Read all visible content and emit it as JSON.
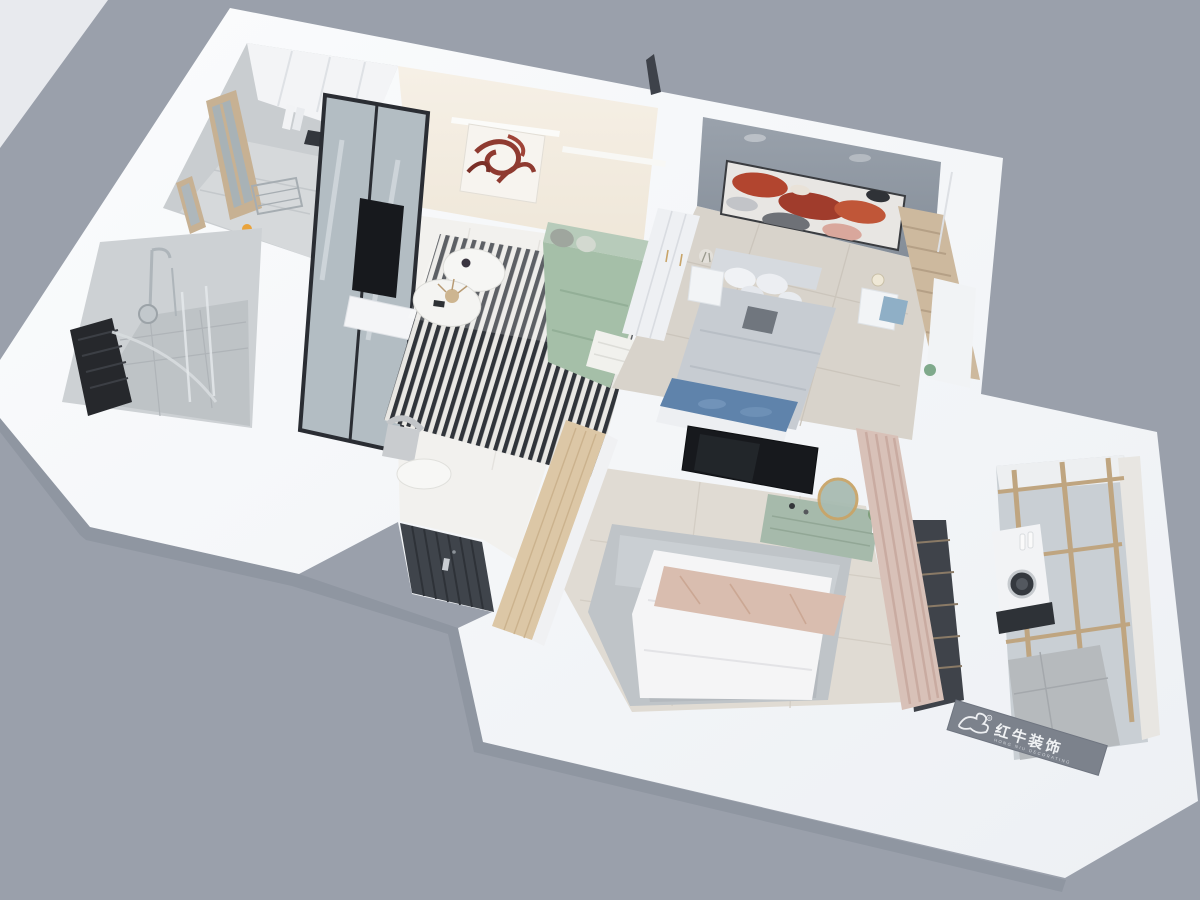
{
  "scene": {
    "type": "3d-apartment-floorplan-render",
    "watermark": {
      "logo_icon": "bull-icon",
      "registered_mark": "®",
      "brand": "红牛装饰",
      "subtitle": "HONG NIU DECORATING"
    },
    "palette": {
      "background": "#9AA0AB",
      "backdrop_slab": "#E8EAEE",
      "walls_white": "#F8F9FB",
      "living_wall_cream": "#F3EDE2",
      "bedroom_accent_wall": "#8F97A1",
      "wood_frame": "#C7B193",
      "wardrobe_wood": "#DCC7A6",
      "sofa_green": "#A5BFA8",
      "blanket_blush": "#D9BDAF",
      "runner_blue": "#5F83AB",
      "rug_stripe_dark": "#30343A",
      "rug_gray": "#BFC4C8",
      "entry_door": "#3F444B",
      "tv_black": "#17191D",
      "dresser_green": "#A6BAAB",
      "mirror_gold": "#C8A468",
      "curtain_pink": "#D8C1B8",
      "tile_gray": "#C9CDD0",
      "banner_gray": "#7C828C",
      "art_red": "#8F3A30"
    }
  }
}
